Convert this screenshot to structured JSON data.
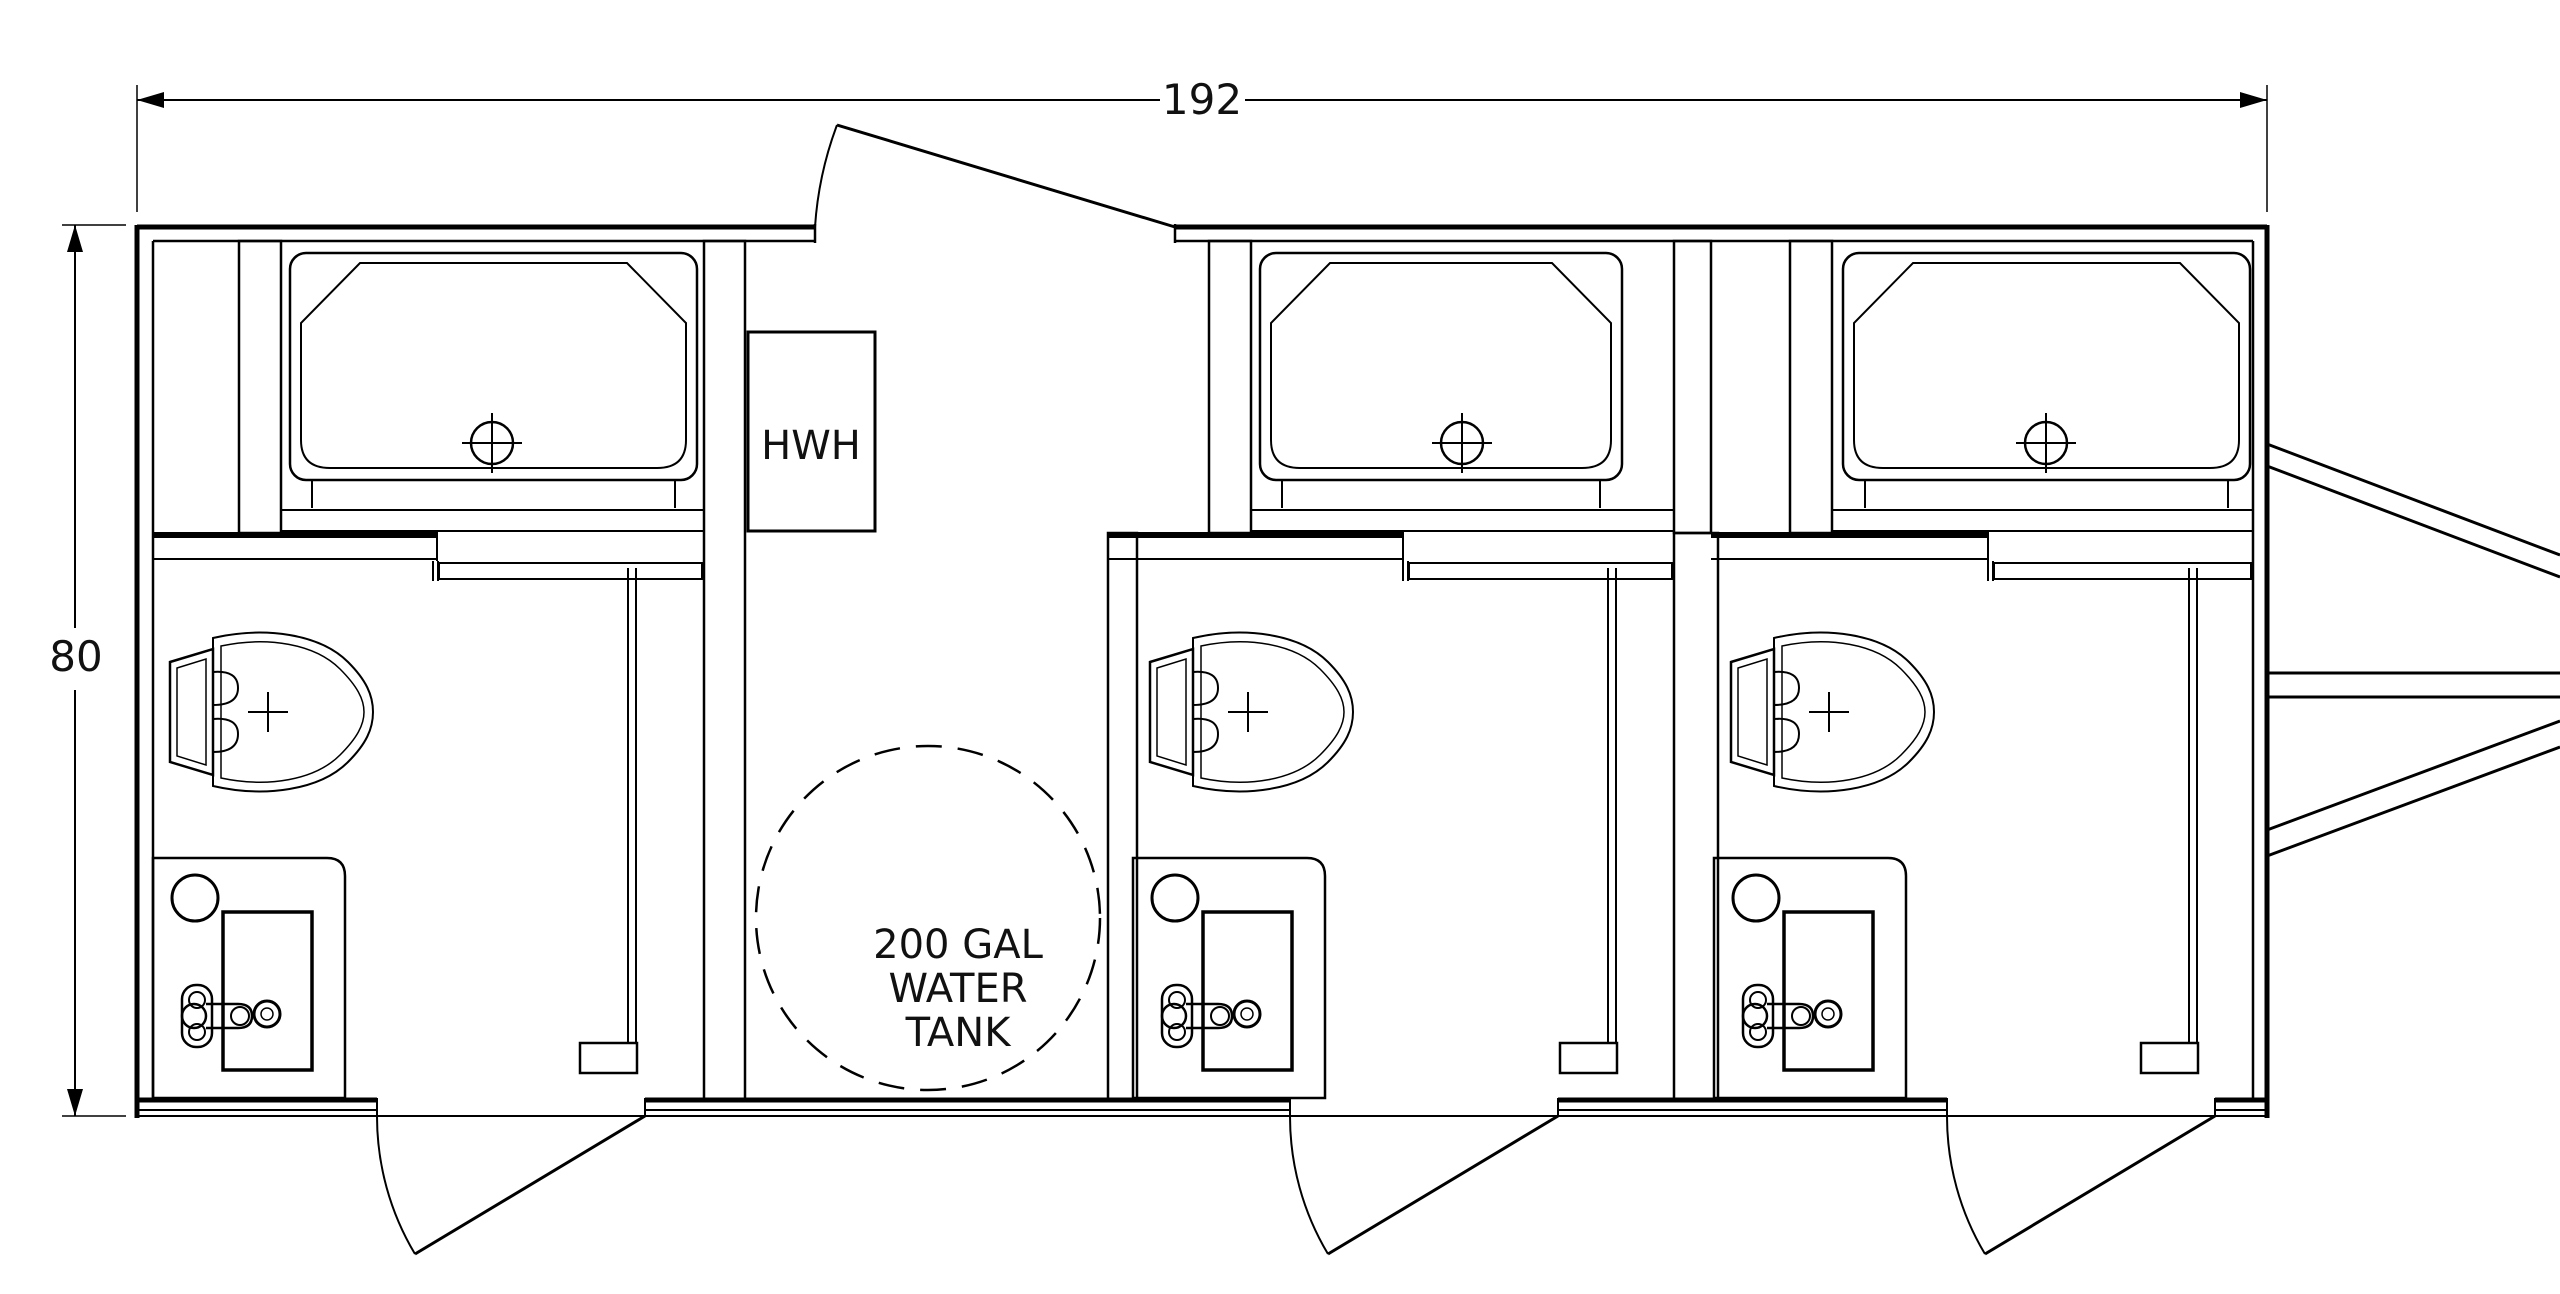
{
  "drawing_type": "floor-plan",
  "subject": "3-stall restroom trailer plan view",
  "colors": {
    "background": "#ffffff",
    "line": "#000000",
    "text": "#111111"
  },
  "dimensions": {
    "overall_width_label": "192",
    "overall_height_label": "80"
  },
  "equipment": {
    "water_heater_label": "HWH",
    "water_tank_label_lines": [
      "200 GAL",
      "WATER",
      "TANK"
    ]
  },
  "units": [
    {
      "name": "restroom-unit-1",
      "fixtures": [
        "shower-pan",
        "toilet",
        "sink-counter",
        "entry-door"
      ]
    },
    {
      "name": "restroom-unit-2",
      "fixtures": [
        "shower-pan",
        "toilet",
        "sink-counter",
        "entry-door"
      ]
    },
    {
      "name": "restroom-unit-3",
      "fixtures": [
        "shower-pan",
        "toilet",
        "sink-counter",
        "entry-door"
      ]
    }
  ],
  "doors": {
    "utility_door_position": "top",
    "entry_door_count": 3
  },
  "hitch": {
    "side": "right"
  }
}
